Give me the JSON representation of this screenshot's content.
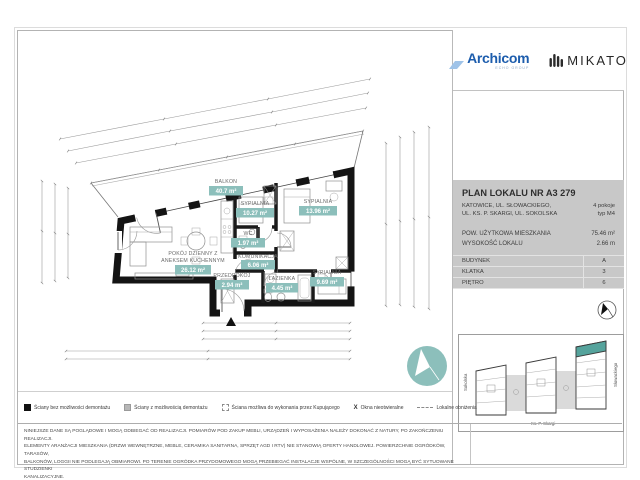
{
  "brand": {
    "archicom": "Archicom",
    "archicom_sub": "ECHO GROUP",
    "mikato": "MIKATO"
  },
  "title_block": {
    "title": "PLAN LOKALU NR A3 279",
    "address_line1": "KATOWICE, UL. SŁOWACKIEGO,",
    "address_line2": "UL. KS. P. SKARGI, UL. SOKOLSKA",
    "rooms_count": "4 pokoje",
    "unit_type": "typ M4",
    "area_label": "POW. UŻYTKOWA MIESZKANIA",
    "area_value": "75.46 m²",
    "height_label": "WYSOKOŚĆ LOKALU",
    "height_value": "2.66 m",
    "details": [
      {
        "label": "BUDYNEK",
        "value": "A"
      },
      {
        "label": "KLATKA",
        "value": "3"
      },
      {
        "label": "PIĘTRO",
        "value": "6"
      }
    ]
  },
  "plan": {
    "rooms": [
      {
        "name": "BALKON",
        "area": "40.7 m²"
      },
      {
        "name": "SYPIALNIA",
        "area": "10.27 m²"
      },
      {
        "name": "SYPIALNIA",
        "area": "13.96 m²"
      },
      {
        "name": "WC",
        "area": "1.97 m²"
      },
      {
        "name_line1": "POKÓJ DZIENNY Z",
        "name_line2": "ANEKSEM KUCHENNYM",
        "area": "26.12 m²"
      },
      {
        "name": "KOMUNIKACJA",
        "area": "6.06 m²"
      },
      {
        "name": "PRZEDPOKÓJ",
        "area": "2.94 m²"
      },
      {
        "name": "ŁAZIENKA",
        "area": "4.45 m²"
      },
      {
        "name": "SYPIALNIA",
        "area": "9.69 m²"
      }
    ],
    "colors": {
      "area_badge": "#8CBFBB",
      "wall": "#141414",
      "north_arrow": "#8CBFBB"
    }
  },
  "legend": {
    "items": [
      {
        "label": "Ściany bez możliwości demontażu"
      },
      {
        "label": "Ściany z możliwością demontażu"
      },
      {
        "label": "Ściana możliwa do wykonania przez Kupującego"
      },
      {
        "symbol": "X",
        "label": "Okna nieotwieralne"
      },
      {
        "label": "Lokalne obniżenia"
      }
    ]
  },
  "siteplan": {
    "street_left": "Sokolska",
    "street_right": "Słowackiego",
    "street_bottom": "Ks. P. Skargi",
    "highlight_color": "#55A39C"
  },
  "disclaimer": {
    "lines": [
      "NINIEJSZE DANE SĄ POGLĄDOWE I MOGĄ ODBIEGAĆ OD REALIZACJI. POMIARÓW POD ZAKUP MEBLI, URZĄDZEŃ I WYPOSAŻENIA NALEŻY DOKONAĆ Z NATURY, PO ZAKOŃCZENIU REALIZACJI.",
      "ELEMENTY ARANŻACJI MIESZKANIA (DRZWI WEWNĘTRZNE, MEBLE, CERAMIKA SANITARNA, SPRZĘT AGD I RTV) NIE STANOWIĄ OFERTY HANDLOWEJ. POWIERZCHNIE OGRÓDKÓW, TARASÓW,",
      "BALKONÓW, LOGGII NIE PODLEGAJĄ OBMIAROWI. PO TERENIE OGRÓDKA PRZYDOMOWEGO MOGĄ PRZEBIEGAĆ INSTALACJE WSPÓLNE, W SZCZEGÓLNOŚCI MOGĄ BYĆ SYTUOWANE STUDZIENKI",
      "KANALIZACYJNE."
    ]
  }
}
